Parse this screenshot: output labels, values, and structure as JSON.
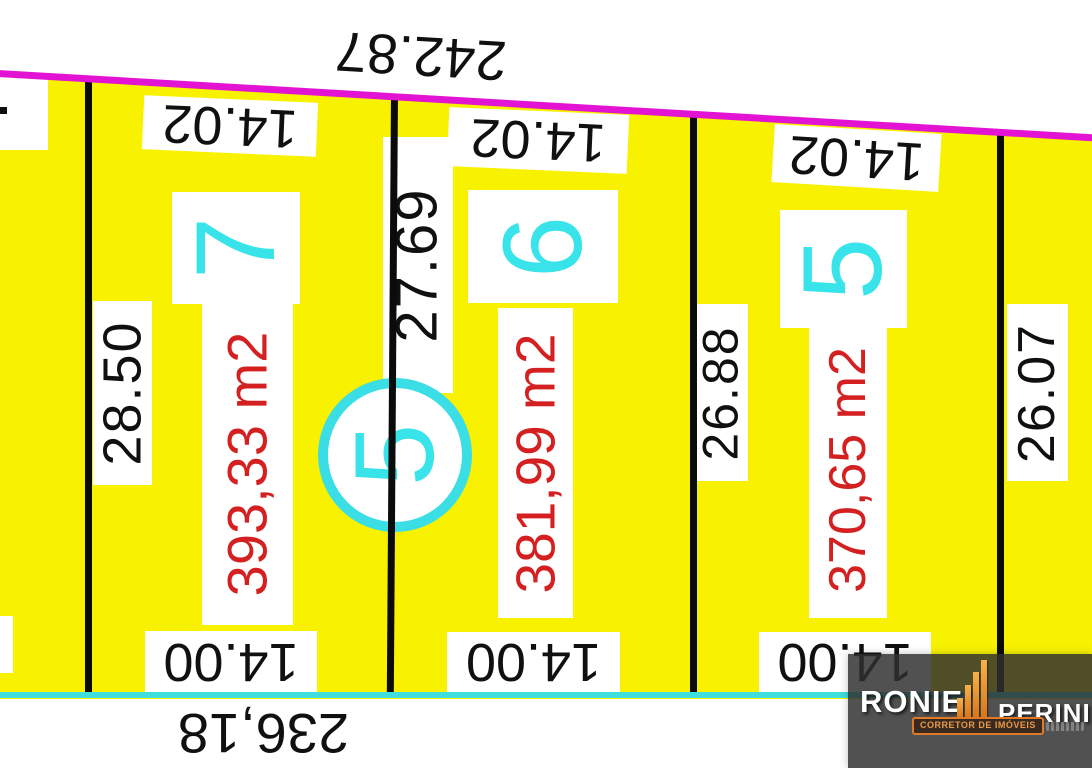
{
  "plan": {
    "front_boundary_total": "242.87",
    "rear_boundary_total": "236,18",
    "adjacent_side_measure": "26.07",
    "block_number": "5"
  },
  "lots": [
    {
      "number": "7",
      "area": "393,33 m2",
      "front": "14.02",
      "rear": "14.00",
      "side": "28.50"
    },
    {
      "number": "6",
      "area": "381,99 m2",
      "front": "14.02",
      "rear": "14.00",
      "side": "27.69"
    },
    {
      "number": "5",
      "area": "370,65 m2",
      "front": "14.02",
      "rear": "14.00",
      "side": "26.88"
    }
  ],
  "watermark": {
    "brand_first": "RONIE",
    "brand_last": "PERINI",
    "tagline": "CORRETOR DE IMÓVEIS"
  },
  "colors": {
    "lot_fill": "#F8F200",
    "front_boundary": "#E213D2",
    "rear_boundary": "#3EDFDC",
    "lot_number_cyan": "#38E3EA",
    "area_red": "#D42020"
  }
}
